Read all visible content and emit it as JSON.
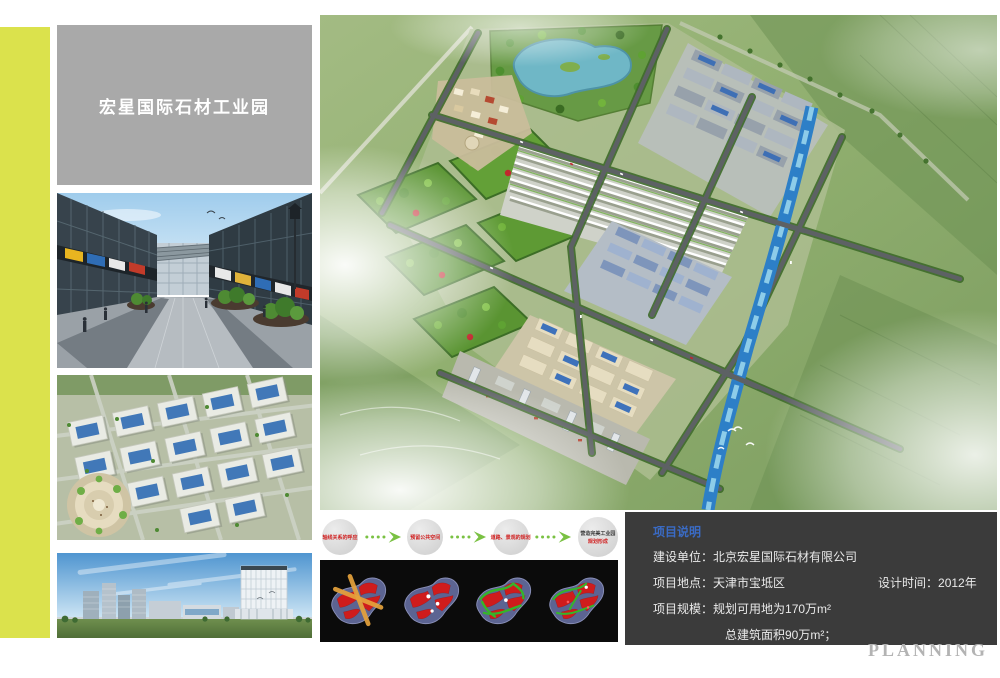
{
  "page": {
    "planning_label": "PLANNING"
  },
  "title_panel": {
    "title": "宏星国际石材工业园"
  },
  "flow": {
    "steps": [
      {
        "label": "轴线关系的呼应"
      },
      {
        "label": "预留公共空间"
      },
      {
        "label": "道路、景观的规划"
      },
      {
        "label": "营造完美工业园",
        "sublabel": "规划形成"
      }
    ]
  },
  "info_panel": {
    "heading": "项目说明",
    "row1_label": "建设单位：",
    "row1_value": "北京宏星国际石材有限公司",
    "row2_label": "项目地点：",
    "row2_value": "天津市宝坻区",
    "row2_right_label": "设计时间：",
    "row2_right_value": "2012年",
    "row3_label": "项目规模：",
    "row3_value": "规划可用地为170万m²",
    "row4_value": "总建筑面积90万m²；"
  },
  "colors": {
    "accent_stripe": "#dbe24c",
    "title_bg": "#a9a9a9",
    "info_bg": "#3b3b3b",
    "heading_blue": "#3a6bc5",
    "step_red": "#d01f1f",
    "arrow_green": "#7ac143",
    "planning_gray": "#b3b3b3"
  }
}
